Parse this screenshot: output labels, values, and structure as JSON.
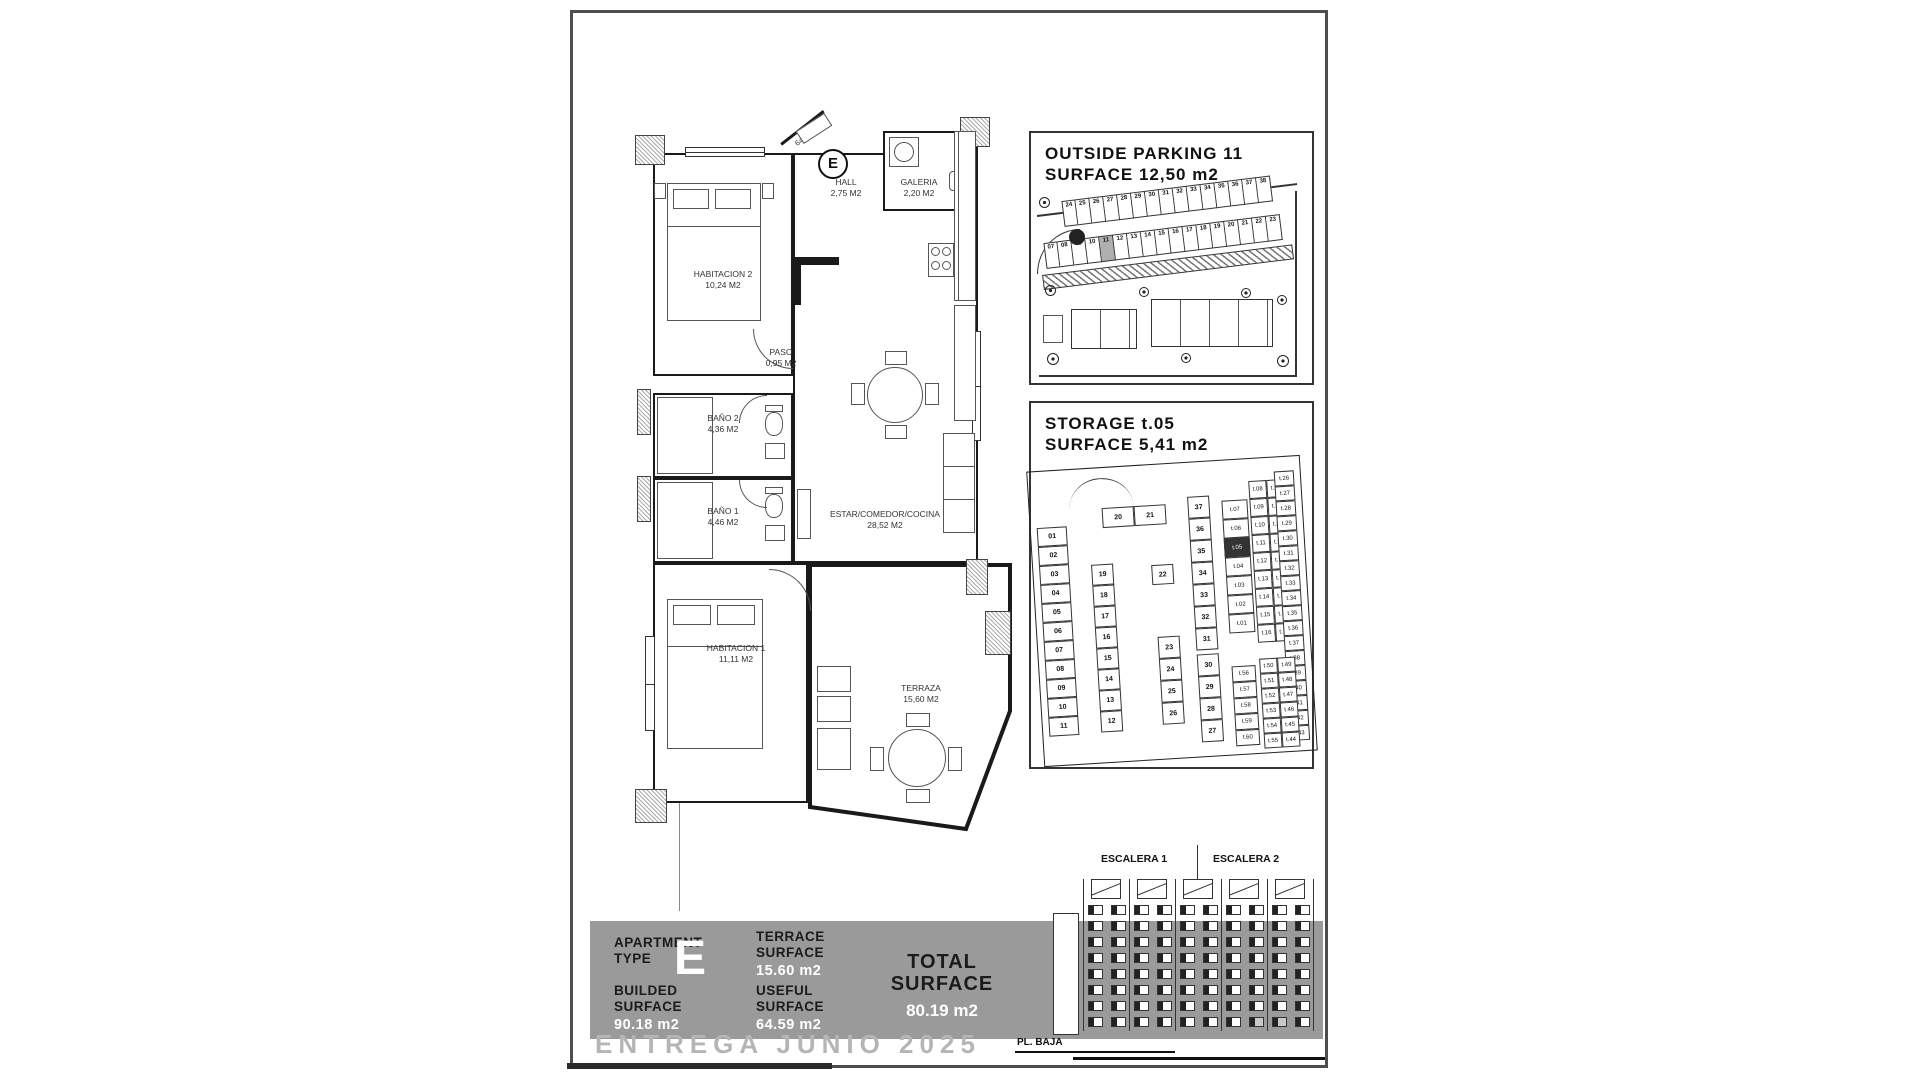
{
  "colors": {
    "band_gray": "#9a9a9a",
    "watermark_gray": "#b5b5b5",
    "highlight_gray": "#b0b0b0",
    "line": "#1a1a1a"
  },
  "floor_plan": {
    "entry_area_label": "64,59 M2",
    "type_badge": "E",
    "rooms": [
      {
        "name": "HABITACION 2",
        "area": "10,24 M2"
      },
      {
        "name": "HALL",
        "area": "2,75 M2"
      },
      {
        "name": "GALERIA",
        "area": "2,20 M2"
      },
      {
        "name": "PASO",
        "area": "0,95 M2"
      },
      {
        "name": "BAÑO 2",
        "area": "4,36 M2"
      },
      {
        "name": "BAÑO 1",
        "area": "4,46 M2"
      },
      {
        "name": "ESTAR/COMEDOR/COCINA",
        "area": "28,52 M2"
      },
      {
        "name": "HABITACION 1",
        "area": "11,11 M2"
      },
      {
        "name": "TERRAZA",
        "area": "15,60 M2"
      }
    ]
  },
  "parking": {
    "title": "OUTSIDE PARKING 11\nSURFACE 12,50 m2",
    "top_row_slots": [
      "24",
      "25",
      "26",
      "27",
      "28",
      "29",
      "30",
      "31",
      "32",
      "33",
      "34",
      "35",
      "36",
      "37",
      "38"
    ],
    "bottom_row_slots": [
      "07",
      "08",
      "09",
      "10",
      "11",
      "12",
      "13",
      "14",
      "15",
      "16",
      "17",
      "18",
      "19",
      "20",
      "21",
      "22",
      "23"
    ],
    "highlighted_slot": "11"
  },
  "storage": {
    "title": "STORAGE t.05\nSURFACE 5,41 m2",
    "left_spots": [
      "01",
      "02",
      "03",
      "04",
      "05",
      "06",
      "07",
      "08",
      "09",
      "10",
      "11"
    ],
    "ramp_spots": [
      "20",
      "21"
    ],
    "mid_single": "22",
    "col_a": [
      "19",
      "18",
      "17",
      "16",
      "15",
      "14",
      "13",
      "12"
    ],
    "col_b": [
      "23",
      "24",
      "25",
      "26"
    ],
    "col_c": [
      "37",
      "36",
      "35",
      "34",
      "33",
      "32",
      "31"
    ],
    "col_d": [
      "30",
      "29",
      "28",
      "27"
    ],
    "tiny_left": [
      "t.07",
      "t.06",
      "t.05",
      "t.04",
      "t.03",
      "t.02",
      "t.01"
    ],
    "tiny_pairs": [
      [
        "t.08",
        "t.25"
      ],
      [
        "t.09",
        "t.24"
      ],
      [
        "t.10",
        "t.23"
      ],
      [
        "t.11",
        "t.22"
      ],
      [
        "t.12",
        "t.21"
      ],
      [
        "t.13",
        "t.20"
      ],
      [
        "t.14",
        "t.19"
      ],
      [
        "t.15",
        "t.18"
      ],
      [
        "t.16",
        "t.17"
      ]
    ],
    "right_edge": [
      "t.26",
      "t.27",
      "t.28",
      "t.29",
      "t.30",
      "t.31",
      "t.32",
      "t.33",
      "t.34",
      "t.35",
      "t.36",
      "t.37",
      "t.38",
      "t.39",
      "t.40",
      "t.41",
      "t.42",
      "t.43"
    ],
    "bottom_pairs": [
      [
        "t.50",
        "t.49"
      ],
      [
        "t.51",
        "t.48"
      ],
      [
        "t.52",
        "t.47"
      ],
      [
        "t.53",
        "t.46"
      ],
      [
        "t.54",
        "t.45"
      ],
      [
        "t.55",
        "t.44"
      ]
    ],
    "bottom_singles": [
      "t.56",
      "t.57",
      "t.58",
      "t.59",
      "t.60"
    ],
    "highlighted_unit": "t.05"
  },
  "elevation": {
    "stair1": "ESCALERA 1",
    "stair2": "ESCALERA 2",
    "ground_label": "PL. BAJA"
  },
  "summary": {
    "apartment_label": "APARTMENT\nTYPE",
    "apartment_value": "E",
    "terrace_label": "TERRACE\nSURFACE",
    "terrace_value": "15.60 m2",
    "builded_label": "BUILDED\nSURFACE",
    "builded_value": "90.18 m2",
    "useful_label": "USEFUL\nSURFACE",
    "useful_value": "64.59 m2",
    "total_label": "TOTAL\nSURFACE",
    "total_value": "80.19 m2"
  },
  "watermark": "ENTREGA JUNIO 2025"
}
